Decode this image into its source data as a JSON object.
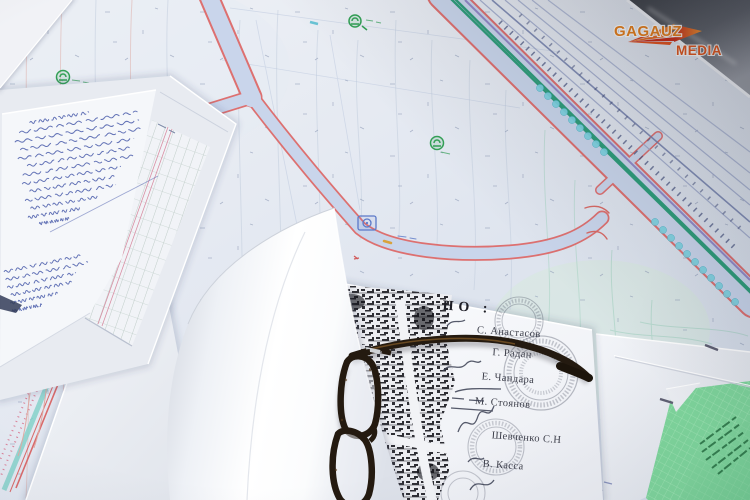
{
  "watermark": {
    "brand_top": "GAGAUZ",
    "brand_bottom": "MEDIA"
  },
  "signature_page": {
    "heading": "НО :",
    "signatories": [
      {
        "name": "С. Анастасов"
      },
      {
        "name": "Г. Радан"
      },
      {
        "name": "Е. Чандара"
      },
      {
        "name": "М. Стоянов"
      },
      {
        "name": "Шевченко С.Н"
      },
      {
        "name": "В. Касса"
      }
    ]
  },
  "colors": {
    "logo_orange": "#e8801c",
    "logo_red": "#cc2d18",
    "map_base": "#e3e8f1",
    "road_fill": "#c9d5eb",
    "road_edge_red": "#dd7070",
    "avenue_green_line": "#2f9d7b",
    "tree_circle_cyan": "#7ed3e2",
    "railway_line_blue": "#97a3c7",
    "handwriting_ink": "#4a5cab",
    "green_paper": "#7fd79c",
    "glasses_frame": "#241a10",
    "stamp_ink": "#343a4e"
  }
}
